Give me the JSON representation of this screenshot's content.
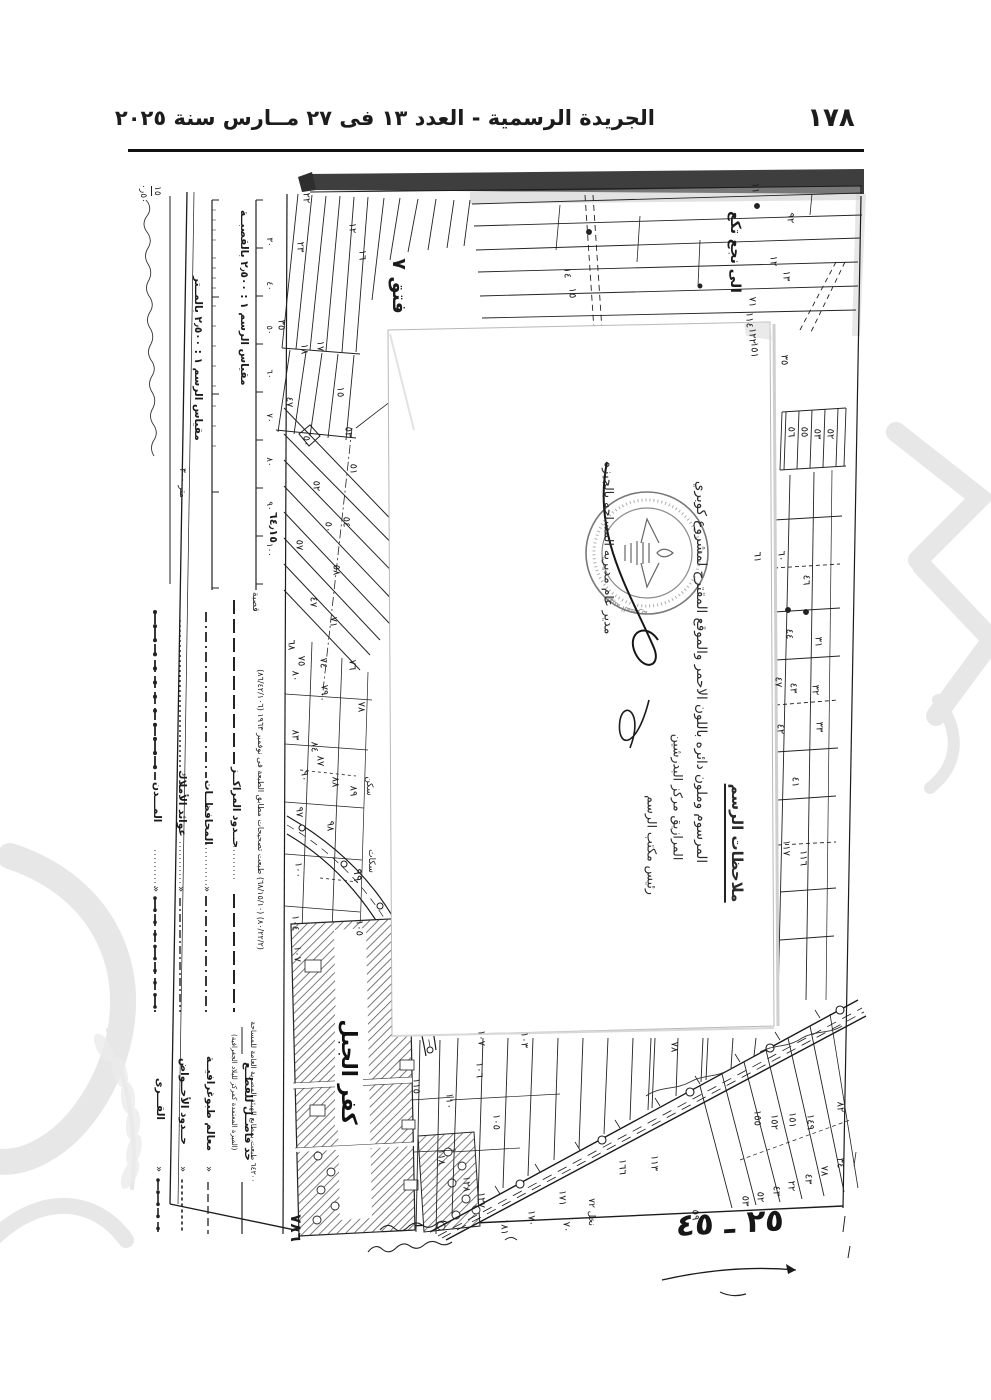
{
  "page": {
    "width": 991,
    "height": 1400,
    "ink": "#1c1c1c",
    "paper": "#ffffff"
  },
  "header": {
    "title": "الجريدة الرسمية - العدد ١٣ فى ٢٧ مــارس سنة ٢٠٢٥",
    "page_number": "١٧٨"
  },
  "map": {
    "corner_fraction_top": "١٥",
    "corner_fraction_bottom": "٥٠ر٠",
    "coordinate_label": "٦٤٫١٥",
    "hod_label": "فتق ٧",
    "village_label": "كفر الجبل",
    "handwriting_top_right": "الى نجع تكع",
    "handwriting_bottom_right": "٢٥ ـ ٤٥",
    "sheet_number": "٧٨٦",
    "notes_box": {
      "heading": "ملاحظات الرسم",
      "body": "المرسوم وملون دائره باللون الاحمر والموقع المقترح لمشروع كوبري",
      "location_line": "المرازيق مركز البدرشين",
      "signature1_title": "رئيس مكتب الرسم",
      "signature2_title": "مدير عام مديريه المساحه بالجيزه"
    },
    "stamp": {
      "ring_text": "الهيئة المصرية العامة للمساحة"
    },
    "parcels": [
      {
        "t": "٢٢",
        "x": 306,
        "y": 198
      },
      {
        "t": "٢٣",
        "x": 300,
        "y": 247
      },
      {
        "t": "١٦",
        "x": 362,
        "y": 255
      },
      {
        "t": "١٢",
        "x": 352,
        "y": 228
      },
      {
        "t": "٣٥",
        "x": 281,
        "y": 325
      },
      {
        "t": "١٨",
        "x": 304,
        "y": 349
      },
      {
        "t": "١٧",
        "x": 320,
        "y": 346
      },
      {
        "t": "١٥",
        "x": 340,
        "y": 392
      },
      {
        "t": "٤٧",
        "x": 289,
        "y": 402
      },
      {
        "t": "٥٣",
        "x": 348,
        "y": 432
      },
      {
        "t": "٥١",
        "x": 353,
        "y": 469
      },
      {
        "t": "٥٠",
        "x": 306,
        "y": 441
      },
      {
        "t": "٥٢",
        "x": 316,
        "y": 486
      },
      {
        "t": "٥٤",
        "x": 346,
        "y": 522
      },
      {
        "t": "٥٠",
        "x": 328,
        "y": 527
      },
      {
        "t": "٥٧",
        "x": 299,
        "y": 545
      },
      {
        "t": "٥٨",
        "x": 336,
        "y": 570
      },
      {
        "t": "٤٧",
        "x": 313,
        "y": 602
      },
      {
        "t": "٧١",
        "x": 333,
        "y": 622
      },
      {
        "t": "٦٨",
        "x": 291,
        "y": 645
      },
      {
        "t": "٧٥",
        "x": 301,
        "y": 661
      },
      {
        "t": "٧٤",
        "x": 323,
        "y": 663
      },
      {
        "t": "٧٦",
        "x": 352,
        "y": 665
      },
      {
        "t": "٨٠",
        "x": 295,
        "y": 676
      },
      {
        "t": "٧٩",
        "x": 324,
        "y": 690
      },
      {
        "t": "٧٨",
        "x": 361,
        "y": 707
      },
      {
        "t": "٨٣",
        "x": 295,
        "y": 735
      },
      {
        "t": "٨٤",
        "x": 314,
        "y": 747
      },
      {
        "t": "٨٧",
        "x": 320,
        "y": 761
      },
      {
        "t": "٩٠",
        "x": 304,
        "y": 776
      },
      {
        "t": "٨٨",
        "x": 335,
        "y": 782
      },
      {
        "t": "٨٩",
        "x": 353,
        "y": 791
      },
      {
        "t": "سكن",
        "x": 369,
        "y": 786,
        "s": 9
      },
      {
        "t": "٩٧",
        "x": 299,
        "y": 812
      },
      {
        "t": "٩٨",
        "x": 330,
        "y": 826
      },
      {
        "t": "١٠٠",
        "x": 298,
        "y": 870
      },
      {
        "t": "سكات",
        "x": 371,
        "y": 861,
        "s": 9
      },
      {
        "t": "٩٩",
        "x": 358,
        "y": 875,
        "s": 12
      },
      {
        "t": "١٠٤",
        "x": 295,
        "y": 923
      },
      {
        "t": "١٠٥",
        "x": 359,
        "y": 928
      },
      {
        "t": "١٠٧",
        "x": 297,
        "y": 954
      },
      {
        "t": "١١٥",
        "x": 416,
        "y": 1086
      },
      {
        "t": "١١٨",
        "x": 441,
        "y": 1157
      },
      {
        "t": "١٢٨",
        "x": 466,
        "y": 1184
      },
      {
        "t": "١٢٧",
        "x": 481,
        "y": 1200
      },
      {
        "t": "١٠٧",
        "x": 481,
        "y": 1038
      },
      {
        "t": "١٠٣",
        "x": 524,
        "y": 1040
      },
      {
        "t": "١٠٦",
        "x": 479,
        "y": 1070
      },
      {
        "t": "١١٠",
        "x": 449,
        "y": 1101
      },
      {
        "t": "١٠٥",
        "x": 496,
        "y": 1122
      },
      {
        "t": "٧٨",
        "x": 674,
        "y": 1047
      },
      {
        "t": "١٦٦",
        "x": 622,
        "y": 1167
      },
      {
        "t": "١١٣",
        "x": 654,
        "y": 1163
      },
      {
        "t": "١٧١",
        "x": 562,
        "y": 1198
      },
      {
        "t": "١٧٠",
        "x": 531,
        "y": 1218
      },
      {
        "t": "٧٠",
        "x": 566,
        "y": 1227
      },
      {
        "t": "نخل ٧٢",
        "x": 591,
        "y": 1212,
        "s": 9
      },
      {
        "t": "١٨١",
        "x": 504,
        "y": 1227
      },
      {
        "t": "٥٩",
        "x": 695,
        "y": 1215
      },
      {
        "t": "١٥٥",
        "x": 757,
        "y": 1118
      },
      {
        "t": "١٥٢",
        "x": 774,
        "y": 1122
      },
      {
        "t": "١٥١",
        "x": 792,
        "y": 1120
      },
      {
        "t": "١٤٩",
        "x": 810,
        "y": 1122
      },
      {
        "t": "٨٢",
        "x": 840,
        "y": 1107
      },
      {
        "t": "٥٣",
        "x": 745,
        "y": 1201
      },
      {
        "t": "٥٢",
        "x": 760,
        "y": 1197
      },
      {
        "t": "٤٣",
        "x": 776,
        "y": 1191
      },
      {
        "t": "٢٢",
        "x": 791,
        "y": 1186
      },
      {
        "t": "٤٣",
        "x": 808,
        "y": 1179
      },
      {
        "t": "٧٨",
        "x": 824,
        "y": 1171
      },
      {
        "t": "٣٤",
        "x": 840,
        "y": 1163
      },
      {
        "t": "١١",
        "x": 755,
        "y": 188
      },
      {
        "t": "٩٢",
        "x": 790,
        "y": 218
      },
      {
        "t": "١٢",
        "x": 773,
        "y": 261
      },
      {
        "t": "١٣",
        "x": 786,
        "y": 276
      },
      {
        "t": "٧١",
        "x": 752,
        "y": 302
      },
      {
        "t": "١١٤",
        "x": 749,
        "y": 320
      },
      {
        "t": "١٢٢",
        "x": 752,
        "y": 336
      },
      {
        "t": "١٥١",
        "x": 754,
        "y": 350
      },
      {
        "t": "٣٥",
        "x": 784,
        "y": 360
      },
      {
        "t": "٥٦",
        "x": 791,
        "y": 432
      },
      {
        "t": "٥٥",
        "x": 804,
        "y": 432
      },
      {
        "t": "٥٣",
        "x": 817,
        "y": 434
      },
      {
        "t": "٥٢",
        "x": 830,
        "y": 434
      },
      {
        "t": "٦١",
        "x": 757,
        "y": 557
      },
      {
        "t": "٦٠",
        "x": 781,
        "y": 556
      },
      {
        "t": "٤٦",
        "x": 806,
        "y": 580
      },
      {
        "t": "٤٤",
        "x": 789,
        "y": 634
      },
      {
        "t": "٣١",
        "x": 818,
        "y": 642
      },
      {
        "t": "٤٧",
        "x": 778,
        "y": 682
      },
      {
        "t": "٤٣",
        "x": 793,
        "y": 688
      },
      {
        "t": "٣٢",
        "x": 815,
        "y": 690
      },
      {
        "t": "٣٣",
        "x": 819,
        "y": 727
      },
      {
        "t": "٤٢",
        "x": 780,
        "y": 729
      },
      {
        "t": "٤١",
        "x": 795,
        "y": 782
      },
      {
        "t": "١١٧",
        "x": 786,
        "y": 848
      },
      {
        "t": "١١٦",
        "x": 803,
        "y": 858
      },
      {
        "t": "١٤",
        "x": 567,
        "y": 273
      },
      {
        "t": "١٥",
        "x": 572,
        "y": 293
      }
    ]
  },
  "legend": {
    "scale_title_qasaba": "مقياس الرسم ١ : ٢٫٥٠٠ بالقصبــة",
    "scale_title_meter": "مقياس الرسم ١ : ٢٫٥٠٠ بالمــتر",
    "scale_ticks": [
      "٣٠",
      "٤٠",
      "٥٠",
      "٦٠",
      "٧٠",
      "٨٠",
      "٩٠",
      "١٠٠"
    ],
    "meter_end_label": "متر ٣٠٠",
    "qasaba_end_label": "قصبة",
    "ditto_mark": "«",
    "group_a": [
      {
        "label": "حــدود المراكــز"
      },
      {
        "label": "المحافظــات"
      },
      {
        "label": "عوائد الأملاك"
      },
      {
        "label": "المـــدن"
      }
    ],
    "group_b": [
      {
        "label": "حد فاصــل للقطــع",
        "sub": "(الميزة المعتمدة كمركز للبلاد الجغرافية)"
      },
      {
        "label": "معالم طبوغرافيــة"
      },
      {
        "label": "حــدود الأحــواض"
      },
      {
        "label": "القـــرى"
      }
    ],
    "print_note_1": "(٨٠/٢٢/٢) (٦٨/١٥/١٠) طبعت تصحيحات مطابق الطبعة فى نوفمبر ١٩٦٣ (٨٦/٤٢/١٠٦)",
    "print_note_2": "٦٤٢٠٠ طبعت بمطابع الهيئة المصرية العامة للمساحة"
  }
}
